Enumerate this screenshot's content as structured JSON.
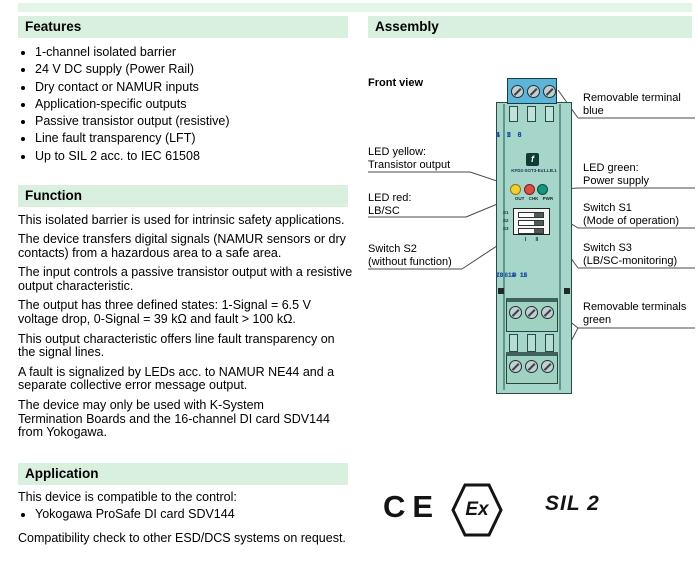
{
  "colors": {
    "section_bar_bg": "#d9f0df",
    "device_body": "#a6d6c9",
    "terminal_blue": "#5cb4d8",
    "led_yellow": "#f2d02e",
    "led_red": "#dc4f45",
    "led_green": "#16957c",
    "terminal_number_blue": "#1a4fa0"
  },
  "sections": {
    "features": {
      "title": "Features",
      "items": [
        "1-channel isolated barrier",
        "24 V DC supply (Power Rail)",
        "Dry contact or NAMUR inputs",
        "Application-specific outputs",
        "Passive transistor output (resistive)",
        "Line fault transparency (LFT)",
        "Up to SIL 2 acc. to IEC 61508"
      ]
    },
    "function": {
      "title": "Function",
      "paragraphs": [
        "This isolated barrier is used for intrinsic safety applications.",
        "The device transfers digital signals (NAMUR sensors or dry contacts) from a hazardous area to a safe area.",
        "The input controls a passive transistor output with a resistive output characteristic.",
        "The output has three defined states: 1-Signal = 6.5 V voltage drop, 0-Signal = 39 kΩ and fault > 100 kΩ.",
        "This output characteristic offers line fault transparency on the signal lines.",
        "A fault is signalized by LEDs acc. to NAMUR NE44 and a separate collective error message output.",
        "The device may only be used with K-System\nTermination Boards and the 16-channel DI card SDV144 from Yokogawa."
      ]
    },
    "application": {
      "title": "Application",
      "intro": "This device is compatible to the control:",
      "items": [
        "Yokogawa ProSafe DI card SDV144"
      ],
      "note": "Compatibility check to other ESD/DCS systems on request."
    },
    "assembly": {
      "title": "Assembly",
      "front_view_label": "Front view",
      "device": {
        "model": "KFD2-SOT3-Ex1.LB.1",
        "logo_glyph": "f",
        "terminal_rows_top": [
          "1 2 3",
          "4 5 6"
        ],
        "terminal_rows_bottom": [
          "7 8 9",
          "10 11 12",
          "13 14 15"
        ],
        "led_caption": "OUT CHK PWR",
        "switch_labels": [
          "S1",
          "S2",
          "S3"
        ],
        "switch_scale": "I II"
      },
      "labels_left": [
        {
          "line1": "LED yellow:",
          "line2": "Transistor output"
        },
        {
          "line1": "LED red:",
          "line2": "LB/SC"
        },
        {
          "line1": "Switch S2",
          "line2": "(without function)"
        }
      ],
      "labels_right": [
        {
          "line1": "Removable terminal",
          "line2": "blue"
        },
        {
          "line1": "LED green:",
          "line2": "Power supply"
        },
        {
          "line1": "Switch S1",
          "line2": "(Mode of operation)"
        },
        {
          "line1": "Switch S3",
          "line2": "(LB/SC-monitoring)"
        },
        {
          "line1": "Removable terminals",
          "line2": "green"
        }
      ],
      "marks": {
        "ce": "CE",
        "ex": "Ex",
        "sil": "SIL 2"
      }
    }
  }
}
